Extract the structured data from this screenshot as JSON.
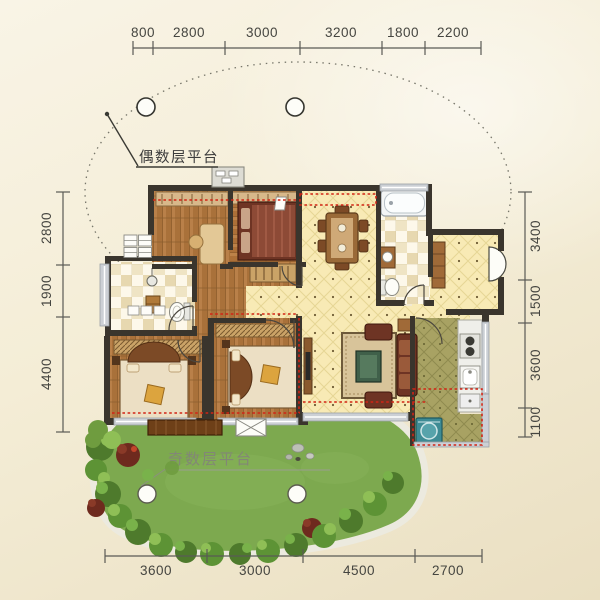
{
  "plan": {
    "platform_labels": {
      "even": "偶数层平台",
      "odd": "奇数层平台"
    },
    "dimensions_mm": {
      "top": [
        "800",
        "2800",
        "3000",
        "3200",
        "1800",
        "2200"
      ],
      "left": [
        "2800",
        "1900",
        "4400"
      ],
      "right": [
        "3400",
        "1500",
        "3600",
        "1100"
      ],
      "bottom": [
        "3600",
        "3000",
        "4500",
        "2700"
      ]
    },
    "colors": {
      "background": "#f4edd8",
      "wall": "#3a352d",
      "window_band": "#ccd0d5",
      "wood_floor": "#a9713a",
      "cream_tile": "#f8eab5",
      "kitchen_tile": "#a8a263",
      "bath_tile": "#efe4c4",
      "lawn": "#7da94f",
      "red_dash": "#d22415",
      "dim_text": "#454540"
    }
  }
}
